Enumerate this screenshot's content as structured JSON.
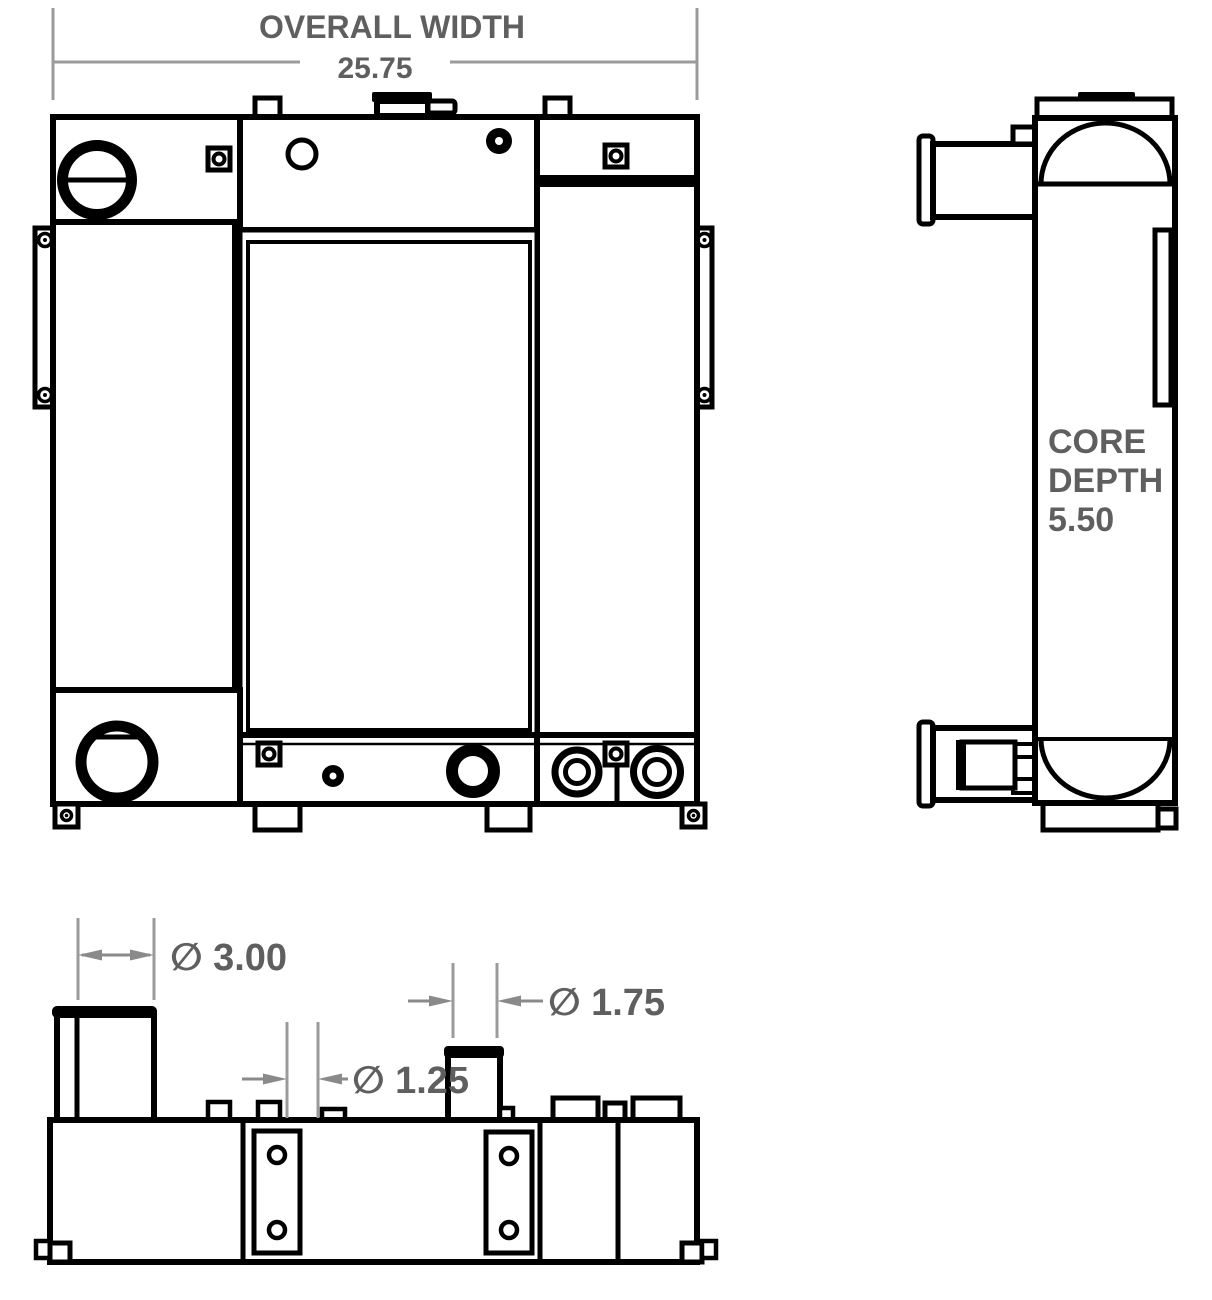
{
  "drawing": {
    "background": "#ffffff",
    "line_color": "#000000",
    "dimension_line_color": "#9b9b9b",
    "dimension_text_color": "#5f5f5f",
    "overall_width": {
      "label": "OVERALL WIDTH",
      "value": "25.75"
    },
    "core_depth": {
      "lines": [
        "CORE",
        "DEPTH",
        "5.50"
      ]
    },
    "diameters": {
      "d300": "∅ 3.00",
      "d125": "∅ 1.25",
      "d175": "∅ 1.75"
    }
  }
}
